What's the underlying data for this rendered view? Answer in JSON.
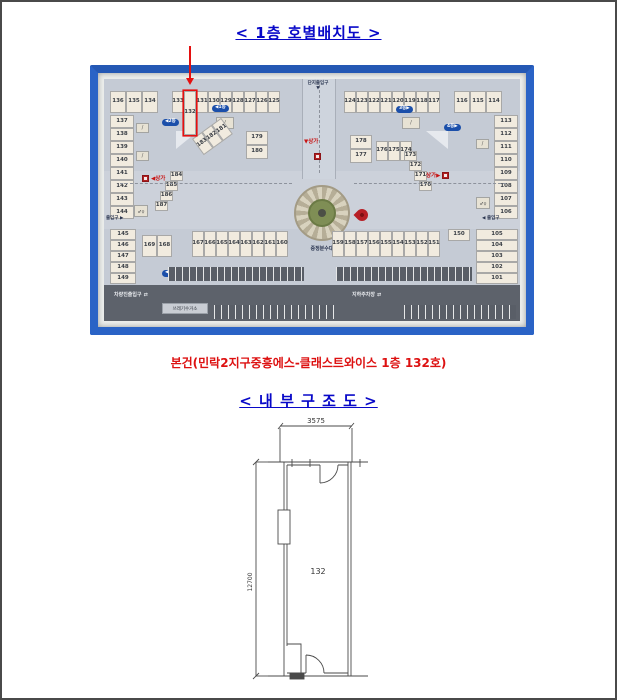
{
  "page": {
    "title_floor": "< 1층  호별배치도 >",
    "subject": "본건(민락2지구중흥에스-클래스트와이스 1층 132호)",
    "title_structure": "< 내 부 구 조 도 >"
  },
  "colors": {
    "title_blue": "#0808c8",
    "subject_red": "#dd1111",
    "frame_blue": "#2a63c6",
    "highlight_red": "#e41010"
  },
  "photo": {
    "highlight_unit": "132",
    "labels": {
      "entrance_top": "단지출입구",
      "entrance_arrow": "▼",
      "sangga_center": "▼상가",
      "sangga_left": "◀상가",
      "sangga_right": "상가▶",
      "fountain": "중정분수대",
      "gate_left": "출입구 ▶",
      "gate_right": "◀ 출입구",
      "parking_gate": "차량진출입구",
      "parking_basement": "지하주차장",
      "trash": "쓰레기수거소"
    },
    "icons": {
      "stairs": "/",
      "restroom": "♂♀",
      "car": "⇄"
    },
    "pills": [
      "◀1동",
      "◀2동",
      "3동▶",
      "4동▶",
      "◀5동",
      "6동▶"
    ],
    "blocks": {
      "tl_row_a": [
        "136",
        "135",
        "134"
      ],
      "tl_row_b": [
        "133",
        "132",
        "131",
        "130",
        "129",
        "128",
        "127",
        "126",
        "125"
      ],
      "left_col": [
        "137",
        "138",
        "139",
        "140",
        "141",
        "142",
        "143",
        "144"
      ],
      "tl_diag": [
        "183",
        "182",
        "181"
      ],
      "tl_stack": [
        "179",
        "180"
      ],
      "tl_diag2": [
        "184",
        "185",
        "186",
        "187"
      ],
      "tr_row_a": [
        "124",
        "123",
        "122",
        "121",
        "120",
        "119",
        "118",
        "117"
      ],
      "tr_row_b": [
        "116",
        "115",
        "114"
      ],
      "right_col": [
        "113",
        "112",
        "111",
        "110",
        "109",
        "108",
        "107",
        "106"
      ],
      "tr_stack": [
        "178",
        "177"
      ],
      "tr_row_mid": [
        "176",
        "175",
        "174"
      ],
      "tr_diag": [
        "173",
        "172",
        "171",
        "170"
      ],
      "bl_col": [
        "145",
        "146",
        "147",
        "148",
        "149"
      ],
      "bl_pair": [
        "169",
        "168"
      ],
      "bl_row": [
        "167",
        "166",
        "165",
        "164",
        "163",
        "162",
        "161",
        "160"
      ],
      "br_row": [
        "159",
        "158",
        "157",
        "156",
        "155",
        "154",
        "153",
        "152",
        "151"
      ],
      "br_cell": "150",
      "br_col": [
        "105",
        "104",
        "103",
        "102",
        "101"
      ]
    }
  },
  "diagram": {
    "width_mm": "3575",
    "height_mm": "12700",
    "unit": "132"
  }
}
